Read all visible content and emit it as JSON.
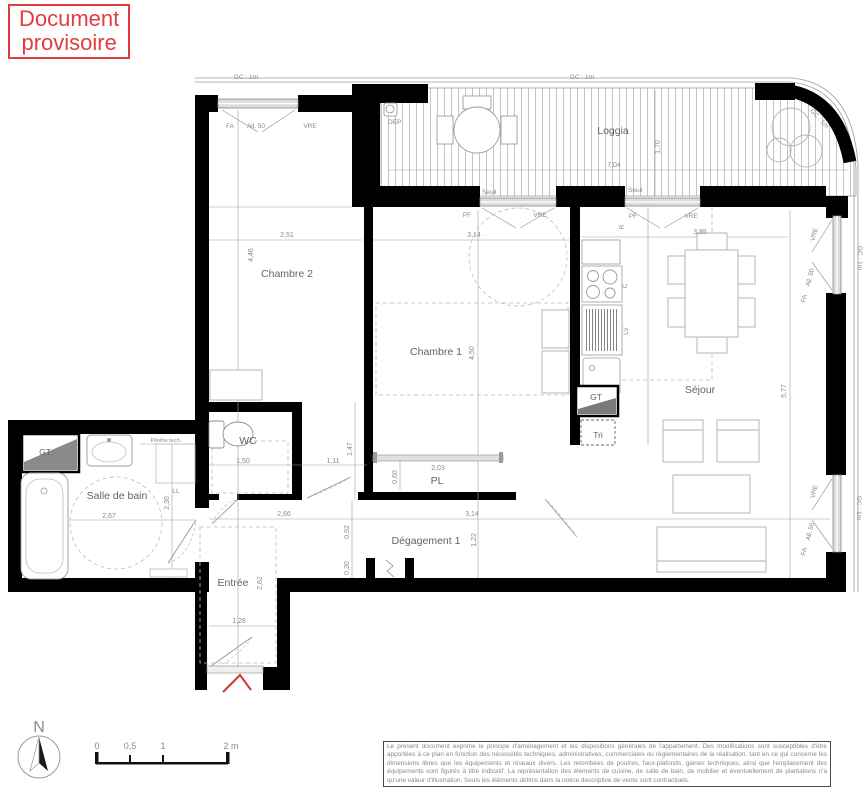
{
  "stamp": {
    "line1": "Document",
    "line2": "provisoire"
  },
  "rooms": {
    "loggia": "Loggia",
    "chambre2": "Chambre 2",
    "chambre1": "Chambre 1",
    "sejour": "Séjour",
    "wc": "WC",
    "sdb": "Salle de bain",
    "entree": "Entrée",
    "degagement": "Dégagement 1",
    "pl": "PL",
    "tri": "Tri",
    "gt": "GT"
  },
  "labels": {
    "gc": "GC : 1m",
    "seuil": "Seuil",
    "dep": "DEP",
    "fa": "FA",
    "all50": "All. 50",
    "vre": "VRE",
    "pf": "PF",
    "r": "R",
    "c": "C",
    "lv": "LV",
    "ll": "LL",
    "plinthe": "Plinthe tech."
  },
  "dims": {
    "d251": "2,51",
    "d446": "4,46",
    "d314a": "3,14",
    "d450": "4,50",
    "d385": "3,85",
    "d577": "5,77",
    "d704": "7,04",
    "d170": "1,70",
    "d150": "1,50",
    "d111": "1,11",
    "d147": "1,47",
    "d203": "2,03",
    "d060": "0,60",
    "d267": "2,67",
    "d230": "2,30",
    "d266": "2,66",
    "d314b": "3,14",
    "d092": "0,92",
    "d030": "0,30",
    "d122": "1,22",
    "d128": "1,28",
    "d262": "2,62"
  },
  "scalebar": {
    "t0": "0",
    "t05": "0,5",
    "t1": "1",
    "t2": "2 m"
  },
  "compass": {
    "north": "N"
  },
  "legal": "Le présent document exprime le principe d'aménagement et les dispositions générales de l'appartement. Des modifications sont susceptibles d'être apportées à ce plan en fonction des nécessités techniques, administratives, commerciales ou réglementaires de la réalisation, tant en ce qui concerne les dimensions libres que les équipements et réseaux divers. Les retombées de poutres, faux-plafonds, gaines techniques, ainsi que l'emplacement des équipements sont figurés à titre indicatif. La représentation des éléments de cuisine, de salle de bain, de mobilier et éventuellement de plantations n'a qu'une valeur d'illustration. Seuls les éléments définis dans la notice descriptive de vente sont contractuels.",
  "colors": {
    "stamp_red": "#e23d3d",
    "wall_black": "#000000",
    "line_grey": "#9a9a9a"
  }
}
